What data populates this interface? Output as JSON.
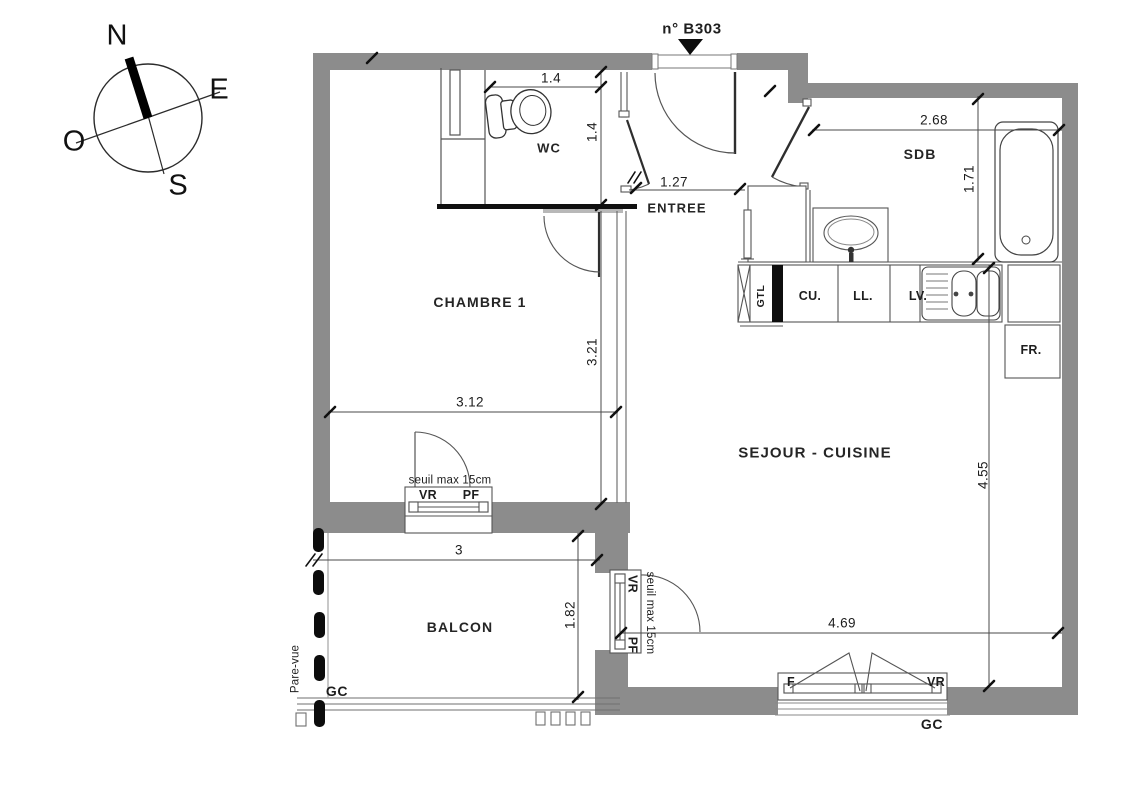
{
  "plan": {
    "unit_label": "n° B303",
    "compass": {
      "n": "N",
      "e": "E",
      "o": "O",
      "s": "S"
    },
    "rooms": {
      "wc": "WC",
      "entree": "ENTREE",
      "chambre": "CHAMBRE 1",
      "sdb": "SDB",
      "sejour": "SEJOUR - CUISINE",
      "balcon": "BALCON"
    },
    "dimensions": {
      "wc_width": "1.4",
      "wc_depth": "1.4",
      "entree_width": "1.27",
      "sdb_width": "2.68",
      "sdb_depth": "1.71",
      "chambre_width": "3.12",
      "chambre_depth": "3.21",
      "balcon_width": "3",
      "balcon_depth": "1.82",
      "sejour_width": "4.69",
      "sejour_depth": "4.55"
    },
    "kitchen": {
      "gtl": "GTL",
      "cu": "CU.",
      "ll": "LL.",
      "lv": "LV.",
      "fr": "FR."
    },
    "windows": {
      "chambre": {
        "sill": "seuil max 15cm",
        "left": "VR",
        "right": "PF"
      },
      "sejour_west": {
        "top": "VR",
        "sill": "seuil max 15cm",
        "bottom": "PF"
      },
      "sejour_south": {
        "left": "F",
        "right": "VR",
        "gc": "GC"
      }
    },
    "balcony": {
      "pare_vue": "Pare-vue",
      "gc": "GC"
    },
    "colors": {
      "wall_gray": "#8c8c8c",
      "line_dark": "#3f3f3f",
      "line_light": "#8a8a8a",
      "black": "#101010"
    }
  }
}
